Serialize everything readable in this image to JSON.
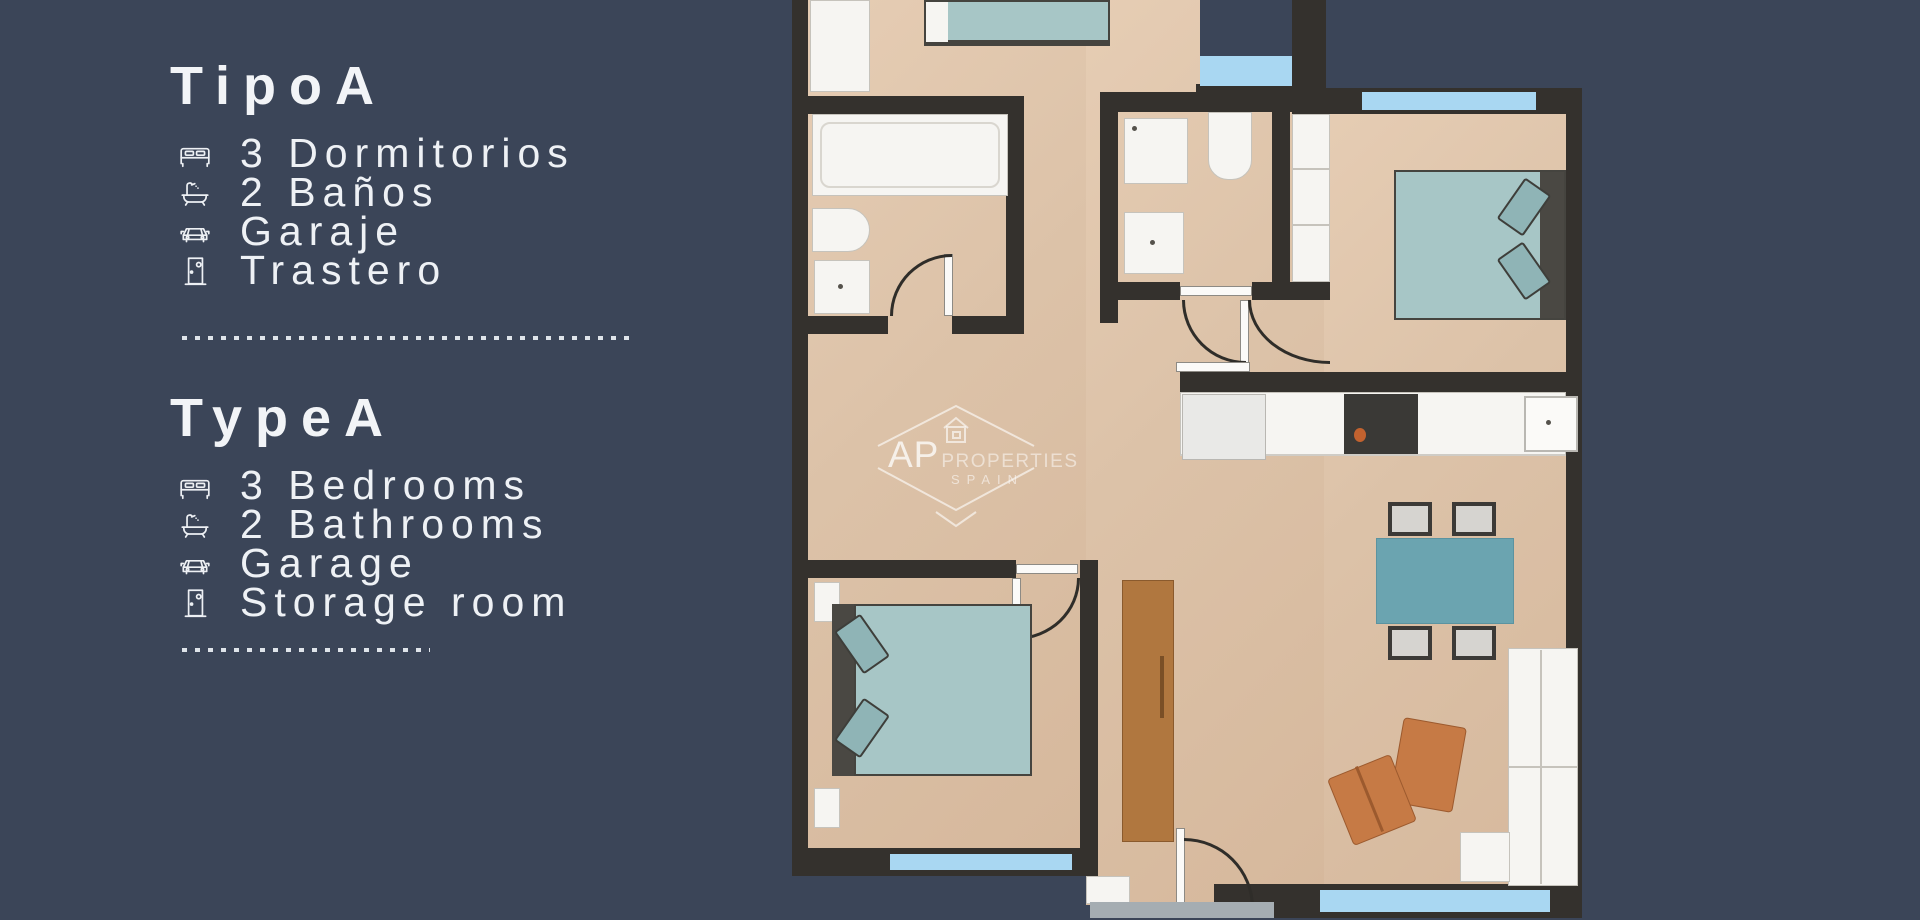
{
  "page": {
    "background_color": "#3b4558",
    "text_color": "#eef1f5"
  },
  "panel_es": {
    "title": "TipoA",
    "features": [
      {
        "icon": "bed-icon",
        "label": "3 Dormitorios"
      },
      {
        "icon": "bathtub-icon",
        "label": "2 Baños"
      },
      {
        "icon": "car-icon",
        "label": "Garaje"
      },
      {
        "icon": "door-icon",
        "label": "Trastero"
      }
    ]
  },
  "panel_en": {
    "title": "TypeA",
    "features": [
      {
        "icon": "bed-icon",
        "label": "3 Bedrooms"
      },
      {
        "icon": "bathtub-icon",
        "label": "2 Bathrooms"
      },
      {
        "icon": "car-icon",
        "label": "Garage"
      },
      {
        "icon": "door-icon",
        "label": "Storage room"
      }
    ]
  },
  "watermark": {
    "brand": "AP",
    "brand_secondary": "PROPERTIES",
    "country": "SPAIN"
  },
  "floorplan": {
    "colors": {
      "wall": "#34312d",
      "floor": "#dcc2a8",
      "window_blue": "#a9d7f2",
      "fixture_white": "#f6f5f2",
      "bed_teal": "#a7c6c6",
      "dining_table_teal": "#6ba4b0",
      "armchair_orange": "#c67a45",
      "wood_door": "#b0773f"
    }
  }
}
